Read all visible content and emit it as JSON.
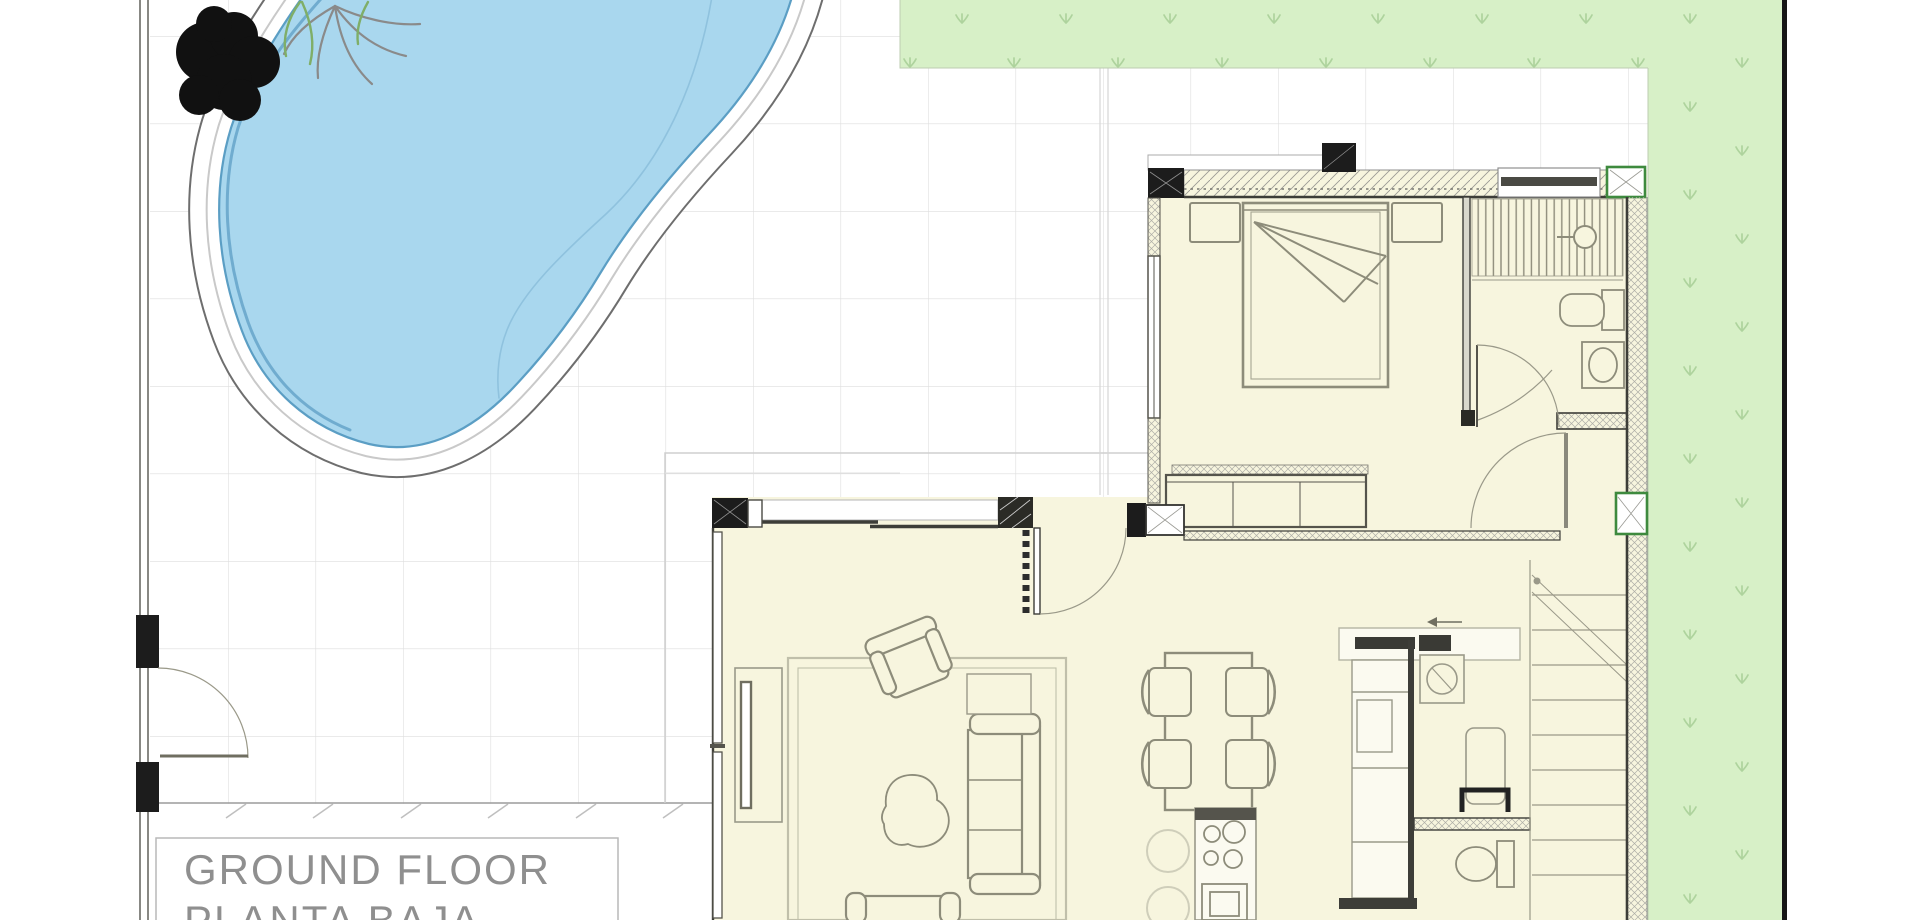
{
  "title": {
    "line1": "GROUND FLOOR",
    "line2": "PLANTA BAJA"
  },
  "colors": {
    "pool_water": "#a9d7ee",
    "pool_edge": "#5b9ec4",
    "deck_outline": "#6e6e6e",
    "grass": "#d7f0c7",
    "grass_tuft": "#aed39d",
    "floor_cream": "#f7f5de",
    "wall_dark": "#3d3d38",
    "furniture_line": "#8d8c7a",
    "grid_line": "#dedede",
    "title_text": "#8f8f8f",
    "column_green": "#3e8a3e"
  }
}
